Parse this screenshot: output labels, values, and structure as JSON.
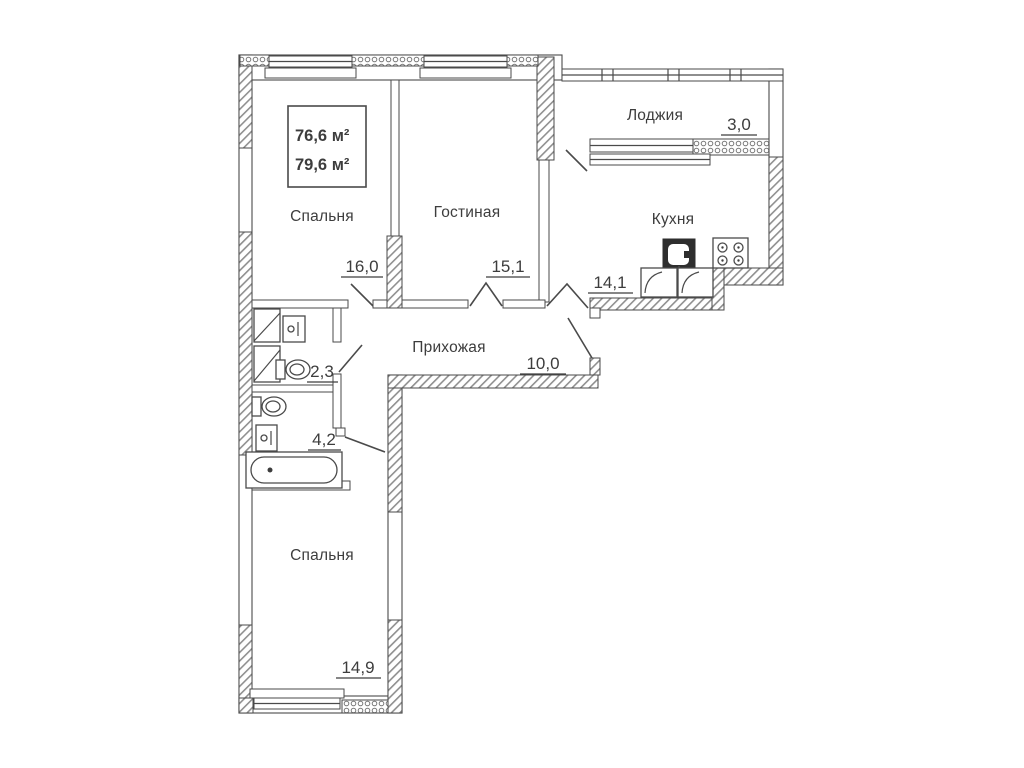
{
  "title": "Apartment floor plan",
  "palette": {
    "ink": "#4a4a4a",
    "paper": "#ffffff",
    "sink_block": "#2e2e2e"
  },
  "area_box": {
    "line1": "76,6 м²",
    "line2": "79,6 м²"
  },
  "rooms": [
    {
      "key": "bedroom-top",
      "label": "Спальня",
      "area": "16,0"
    },
    {
      "key": "living-room",
      "label": "Гостиная",
      "area": "15,1"
    },
    {
      "key": "kitchen",
      "label": "Кухня",
      "area": "14,1"
    },
    {
      "key": "loggia",
      "label": "Лоджия",
      "area": "3,0"
    },
    {
      "key": "hallway",
      "label": "Прихожая",
      "area": "10,0"
    },
    {
      "key": "wc",
      "label": "",
      "area": "2,3"
    },
    {
      "key": "bathroom",
      "label": "",
      "area": "4,2"
    },
    {
      "key": "bedroom-bottom",
      "label": "Спальня",
      "area": "14,9"
    }
  ],
  "fixture_icons": [
    "toilet-icon",
    "washbasin-icon",
    "bathtub-icon",
    "kitchen-sink-icon",
    "stove-icon",
    "vent-shaft-icon",
    "kitchen-counter-icon"
  ]
}
